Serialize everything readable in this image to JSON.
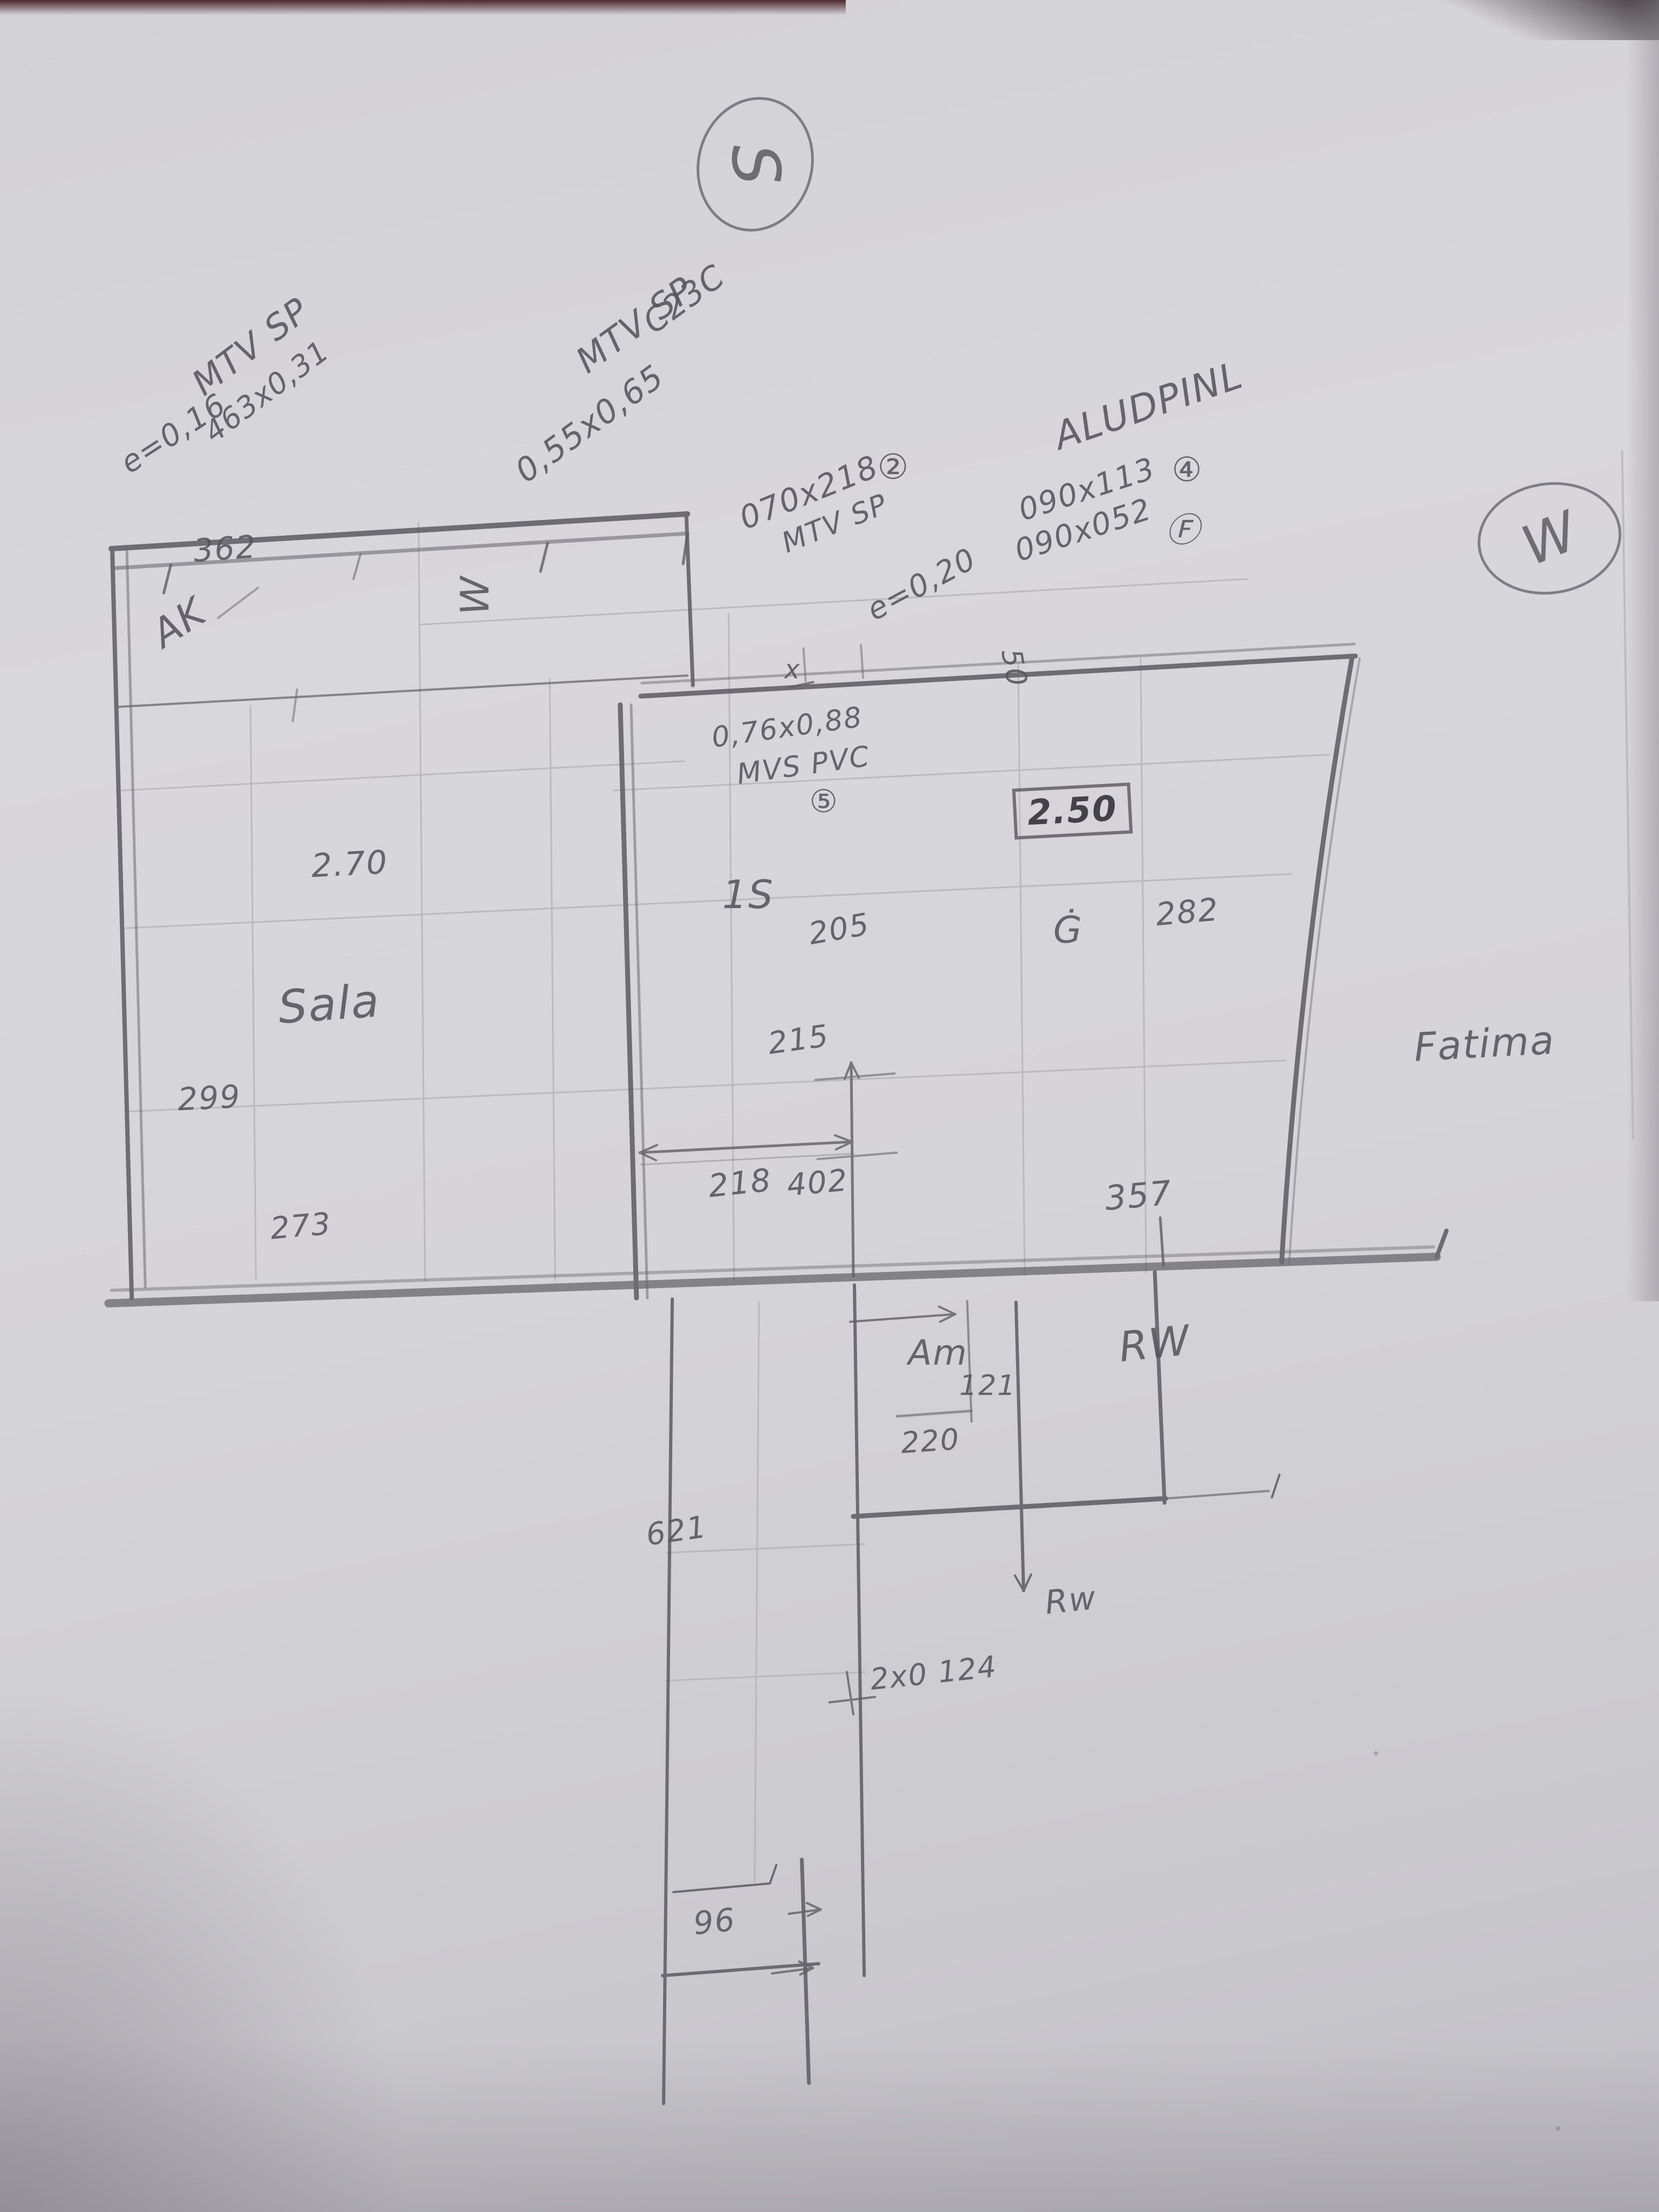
{
  "meta": {
    "description": "Hand-drawn pencil floor plan sketch on grey paper"
  },
  "colors": {
    "paper": "#d5d4d8",
    "pencil_dark": "#5a5a60",
    "pencil_faint": "#b2b1b6",
    "photo_edge": "#401a20"
  },
  "compass": {
    "south": "S",
    "west": "W"
  },
  "labels": {
    "mtv_sp_1": "MTV SP",
    "e016": "e=0,16",
    "d463": "463x0,31",
    "mtv_sp_2": "MTV SP",
    "c23c": "C23C",
    "d055": "0,55x0,65",
    "d070218": "070x218",
    "mtv_sp_3": "MTV SP",
    "circ2": "②",
    "e020": "e=0,20",
    "alud": "ALUDPINL",
    "d090113": "090x113",
    "circ4": "④",
    "d090052": "090x052",
    "circf": "Ⓕ",
    "d362": "362",
    "ak": "AK",
    "w_strip": "W",
    "xmark": "x",
    "d50": "50",
    "d076088": "0,76x0,88",
    "mvs_pvc": "MVS PVC",
    "circ5": "⑤",
    "d250": "2.50",
    "g_dot": "Ġ",
    "d282": "282",
    "d270": "2.70",
    "sala": "Sala",
    "room_1s": "1S",
    "d205": "205",
    "d215": "215",
    "d218": "218",
    "d402": "402",
    "d357": "357",
    "fatima": "Fatima",
    "am": "Am",
    "d121": "121",
    "d220": "220",
    "rw_big": "RW",
    "d621": "621",
    "rw_small": "Rw",
    "d2x0124": "2x0 124",
    "d96": "96",
    "d299": "299",
    "d273": "273"
  }
}
